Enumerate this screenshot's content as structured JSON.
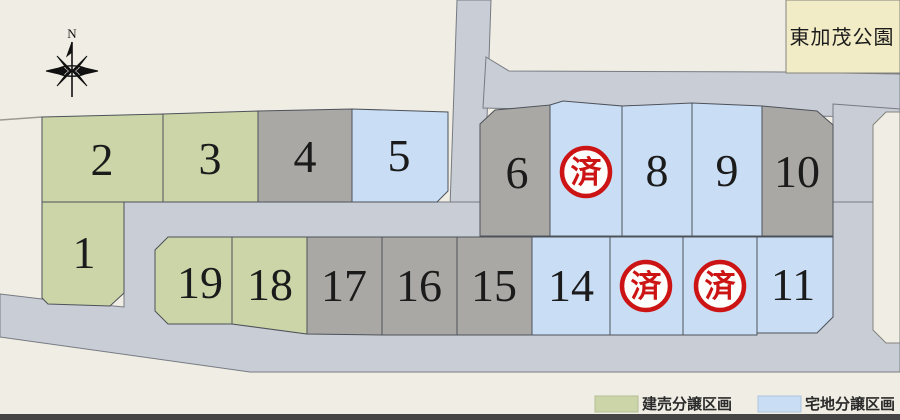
{
  "map": {
    "park_label": "東加茂公園",
    "compass_label": "N",
    "stamp_label": "済"
  },
  "lots": [
    {
      "label": "2",
      "category": "green"
    },
    {
      "label": "3",
      "category": "green"
    },
    {
      "label": "4",
      "category": "gray"
    },
    {
      "label": "5",
      "category": "blue"
    },
    {
      "label": "1",
      "category": "green"
    },
    {
      "label": "19",
      "category": "green"
    },
    {
      "label": "18",
      "category": "green"
    },
    {
      "label": "17",
      "category": "gray"
    },
    {
      "label": "16",
      "category": "gray"
    },
    {
      "label": "15",
      "category": "gray"
    },
    {
      "label": "6",
      "category": "gray"
    },
    {
      "label": "",
      "category": "blue",
      "sold": true
    },
    {
      "label": "8",
      "category": "blue"
    },
    {
      "label": "9",
      "category": "blue"
    },
    {
      "label": "10",
      "category": "gray"
    },
    {
      "label": "14",
      "category": "blue"
    },
    {
      "label": "",
      "category": "blue",
      "sold": true
    },
    {
      "label": "",
      "category": "blue",
      "sold": true
    },
    {
      "label": "11",
      "category": "blue"
    }
  ],
  "legend": [
    {
      "label": "建売分譲区画",
      "color": "#ccd5a8"
    },
    {
      "label": "宅地分譲区画",
      "color": "#c9ddf5"
    }
  ],
  "colors": {
    "green": "#ccd5a8",
    "blue": "#c9ddf5",
    "gray": "#a9a8a4",
    "road": "#c9cdd6",
    "park": "#f1ecc6",
    "background": "#f0eee4",
    "stamp_red": "#cc1414",
    "ink": "#1b1b1b"
  }
}
